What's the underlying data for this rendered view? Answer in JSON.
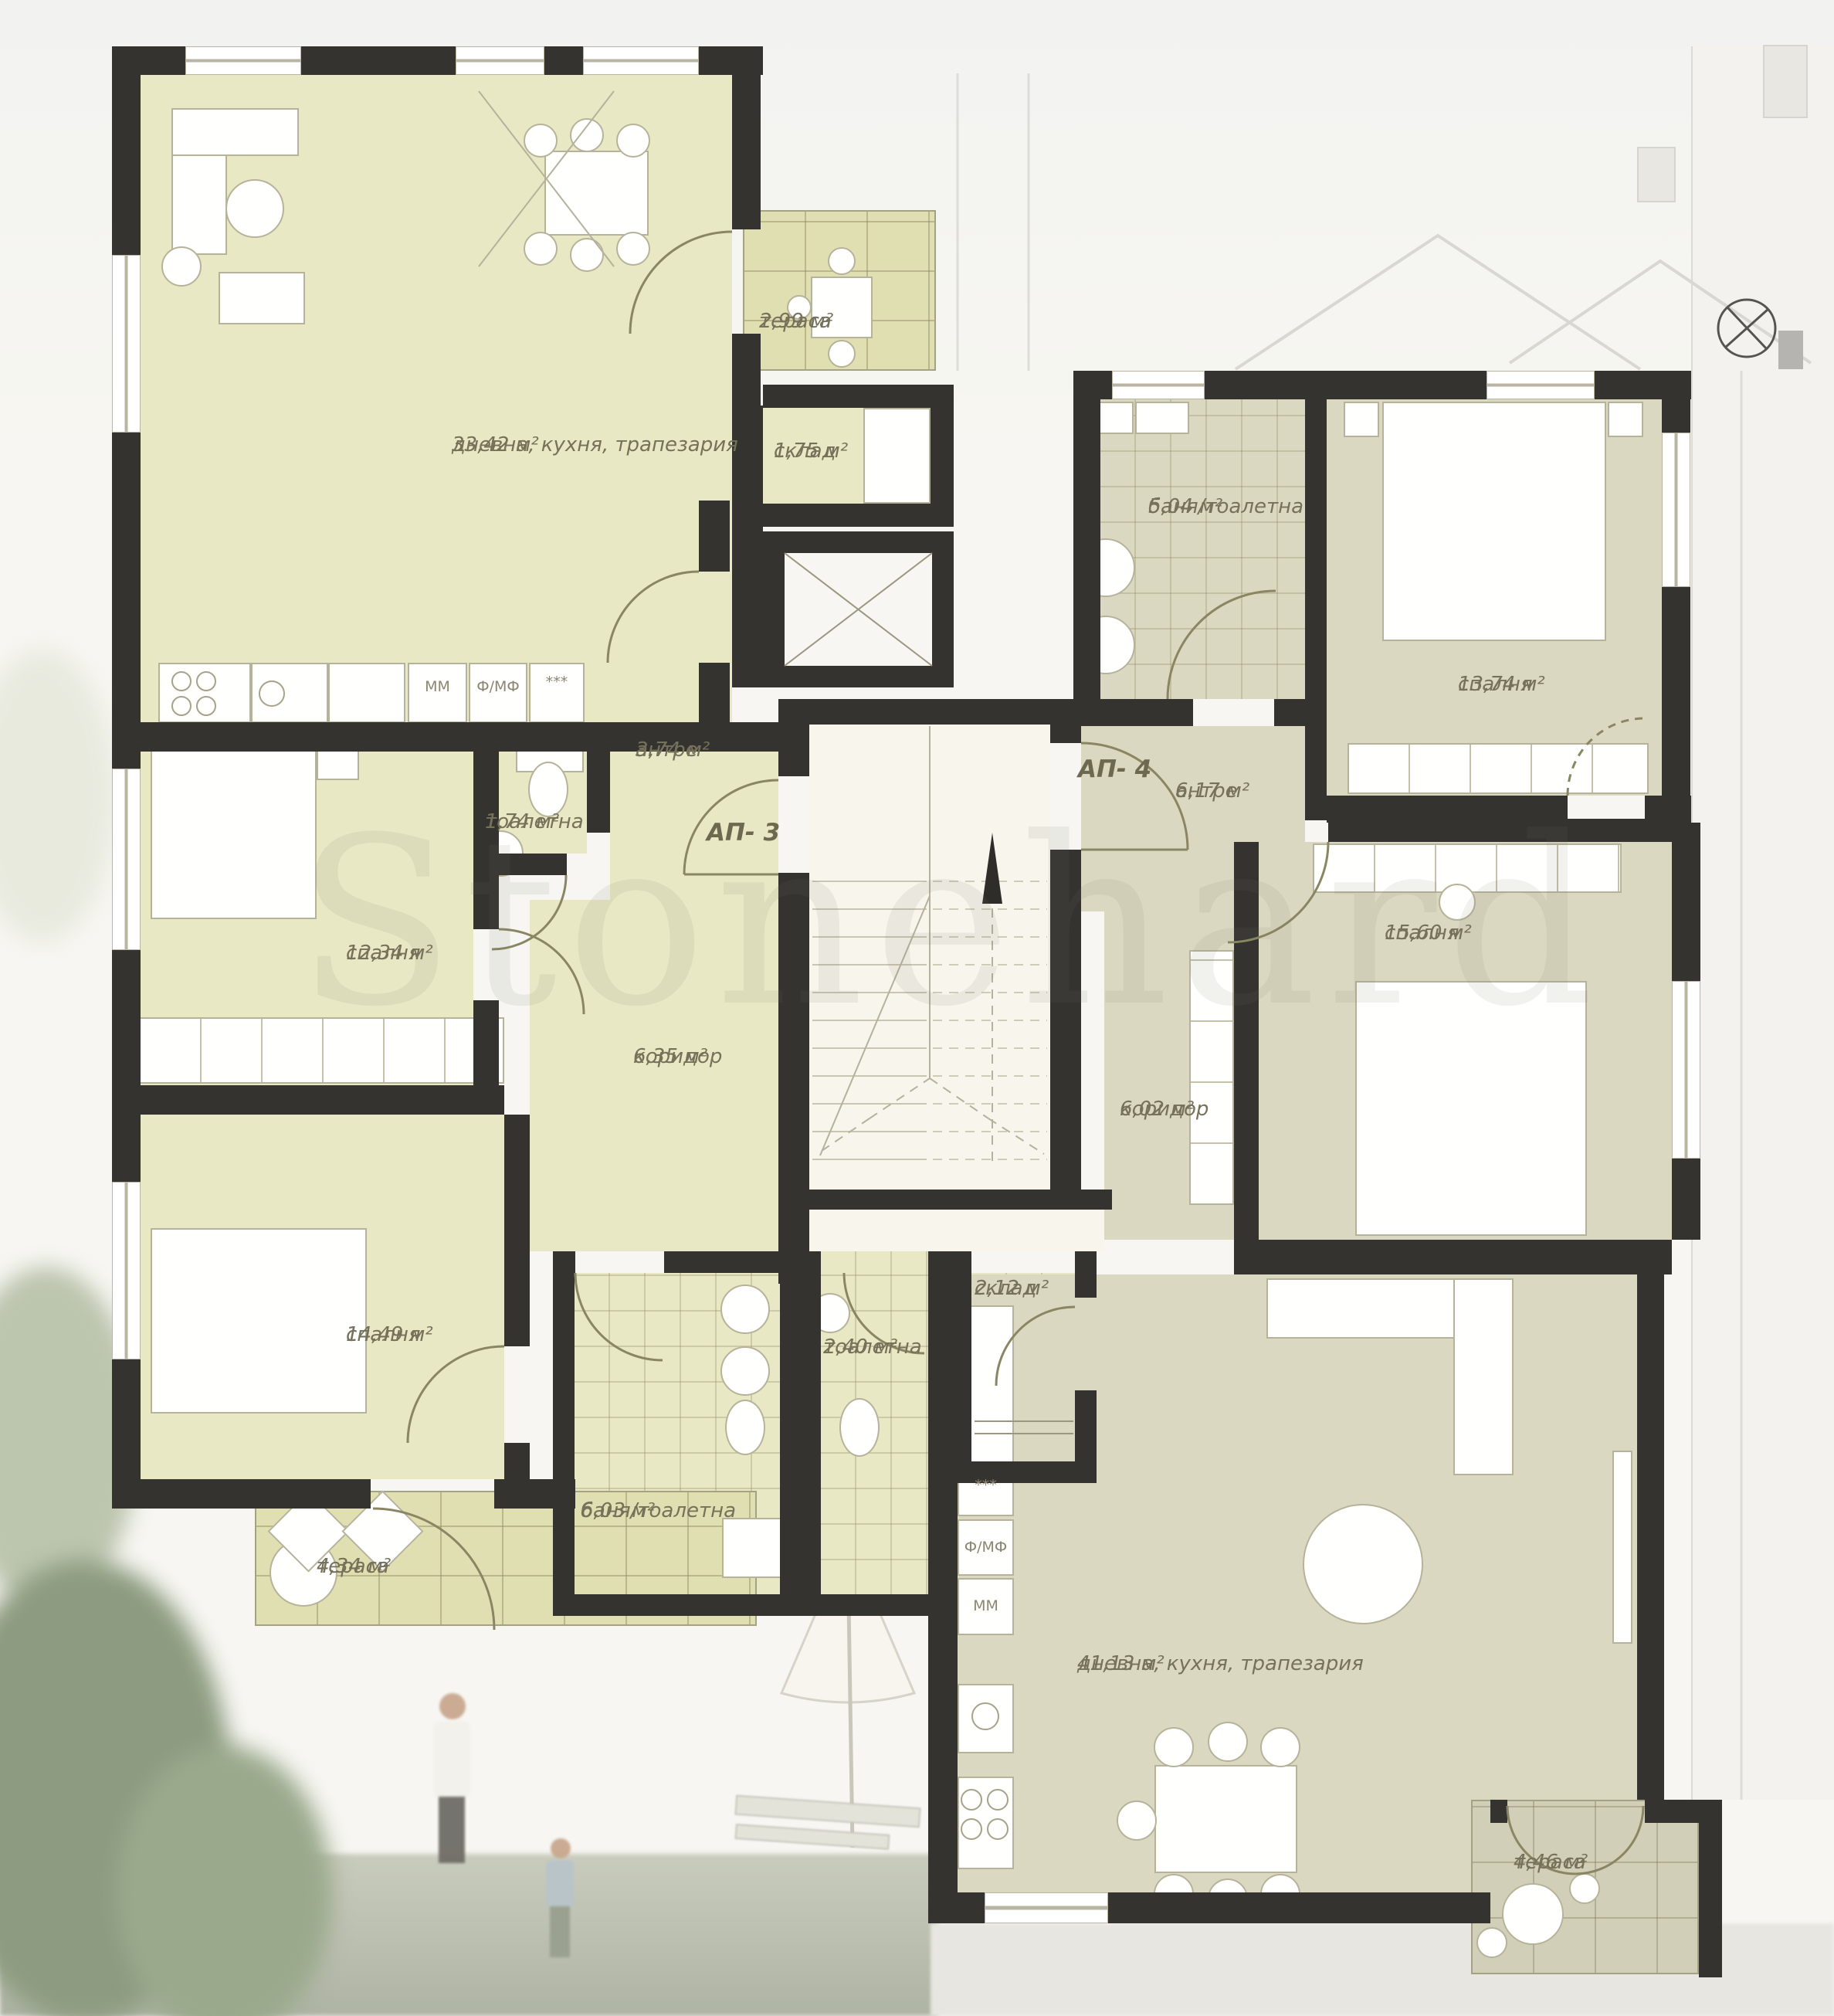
{
  "watermark": "Stonehard",
  "apartments": {
    "ap3": {
      "label": "АП- 3",
      "kitchen_labels": [
        "ММ",
        "Ф/МФ",
        "***"
      ],
      "rooms": [
        {
          "name": "дневна, кухня, трапезария",
          "area": "33,42 м²"
        },
        {
          "name": "тераса",
          "area": "2,99 м²"
        },
        {
          "name": "склад",
          "area": "1,75 м²"
        },
        {
          "name": "антре",
          "area": "3,74 м²"
        },
        {
          "name": "тоалетна",
          "area": "1,74 м²"
        },
        {
          "name": "спалня",
          "area": "12,34 м²"
        },
        {
          "name": "коридор",
          "area": "6,35 м²"
        },
        {
          "name": "спалня",
          "area": "14,49 м²"
        },
        {
          "name": "баня/тоалетна",
          "area": "6,03 м²"
        },
        {
          "name": "тераса",
          "area": "4,34 м²"
        }
      ]
    },
    "ap4": {
      "label": "АП- 4",
      "kitchen_labels": [
        "***",
        "Ф/МФ",
        "ММ"
      ],
      "rooms": [
        {
          "name": "баня/тоалетна",
          "area": "5,04 м²"
        },
        {
          "name": "антре",
          "area": "6,17 м²"
        },
        {
          "name": "спалня",
          "area": "13,74 м²"
        },
        {
          "name": "спалня",
          "area": "15,60 м²"
        },
        {
          "name": "коридор",
          "area": "6,02 м²"
        },
        {
          "name": "дневна, кухня, трапезария",
          "area": "41,13 м²"
        },
        {
          "name": "тераса",
          "area": "4,46 м²"
        }
      ]
    },
    "common": {
      "rooms": [
        {
          "name": "тоалетна",
          "area": "2,40 м²"
        },
        {
          "name": "склад",
          "area": "2,12 м²"
        }
      ]
    }
  },
  "colors": {
    "wall": "#343330",
    "room_ap3": "#e9e8c4",
    "room_ap4": "#dbd8c1",
    "terrace_ap3": "#e0dfb2",
    "terrace_ap4": "#d2cfb8",
    "stairs": "#f8f5ec",
    "label_text": "#76715a"
  }
}
